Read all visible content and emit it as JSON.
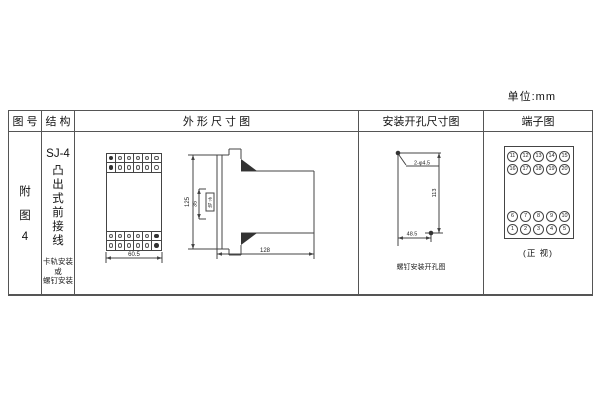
{
  "unit_label": "单位:mm",
  "table": {
    "headers": {
      "figure_no": "图 号",
      "structure": "结 构",
      "outline": "外 形 尺 寸 图",
      "install": "安装开孔尺寸图",
      "terminal": "端子图"
    },
    "figure": {
      "l1": "附",
      "l2": "图",
      "l3": "4"
    },
    "structure": {
      "model": "SJ-4",
      "c0": "凸",
      "c1": "出",
      "c2": "式",
      "c3": "前",
      "c4": "接",
      "c5": "线",
      "n0": "卡轨安装",
      "n1": "或",
      "n2": "螺钉安装"
    }
  },
  "outline": {
    "front_width": "60.5",
    "height": "125",
    "rail_span": "35",
    "rail_label_1": "卡",
    "rail_label_2": "轨",
    "depth": "128"
  },
  "install": {
    "holes": "2-φ4.5",
    "vertical": "113",
    "horizontal": "48.5",
    "caption": "螺钉安装开孔图"
  },
  "terminal": {
    "caption": "(正 视)",
    "r1": [
      "11",
      "12",
      "13",
      "14",
      "15"
    ],
    "r2": [
      "16",
      "17",
      "18",
      "19",
      "20"
    ],
    "r3": [
      "6",
      "7",
      "8",
      "9",
      "10"
    ],
    "r4": [
      "1",
      "2",
      "3",
      "4",
      "5"
    ]
  }
}
